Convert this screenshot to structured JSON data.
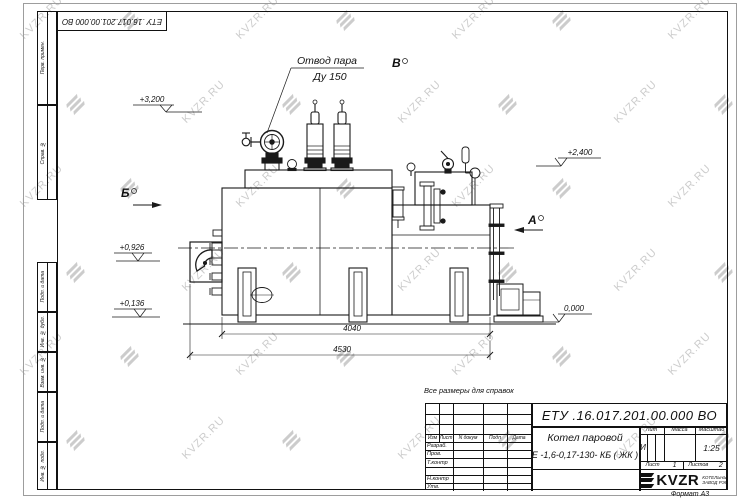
{
  "watermark": {
    "text": "KVZR.RU"
  },
  "frame": {
    "corner_doc_number": "ЕТУ .16.017.201.00.000  ВО",
    "margin_stamps": [
      "Перв. примен.",
      "Справ. №",
      "Подп. и дата",
      "Инв. № дубл.",
      "Взам. инв. №",
      "Подп. и дата",
      "Инв. № подл."
    ],
    "format_label": "Формат А3"
  },
  "drawing": {
    "note": "Все размеры для справок",
    "callout": {
      "line1": "Отвод пара",
      "line2": "Ду 150"
    },
    "view_markers": {
      "top": "В",
      "left": "Б",
      "right": "А"
    },
    "elevations": {
      "top_left": "+3,200",
      "top_right": "+2,400",
      "mid_left": "+0,926",
      "low_left": "+0,136",
      "ground": "0,000"
    },
    "dimensions": {
      "inner": "4040",
      "overall": "4530"
    }
  },
  "title_block": {
    "doc_number": "ЕТУ .16.017.201.00.000  ВО",
    "product_line1": "Котел паровой",
    "product_line2": "Е -1,6-0,17-130- КБ ( ЖК )",
    "col_headers": [
      "Изм",
      "Лист",
      "N докум",
      "Подп",
      "Дата"
    ],
    "row_labels": [
      "Разраб.",
      "Пров.",
      "Т.контр",
      "Н.контр",
      "Утв."
    ],
    "lit_header": "Лит",
    "mass_header": "Масса",
    "scale_header": "Масштаб",
    "lit_value": "И",
    "scale_value": "1:25",
    "sheet_label": "Лист",
    "sheet_value": "1",
    "sheets_label": "Листов",
    "sheets_value": "2",
    "company_name": "KVZR",
    "company_sub1": "КОТЕЛЬНЫЙ",
    "company_sub2": "ЗАВОД РЭП"
  }
}
